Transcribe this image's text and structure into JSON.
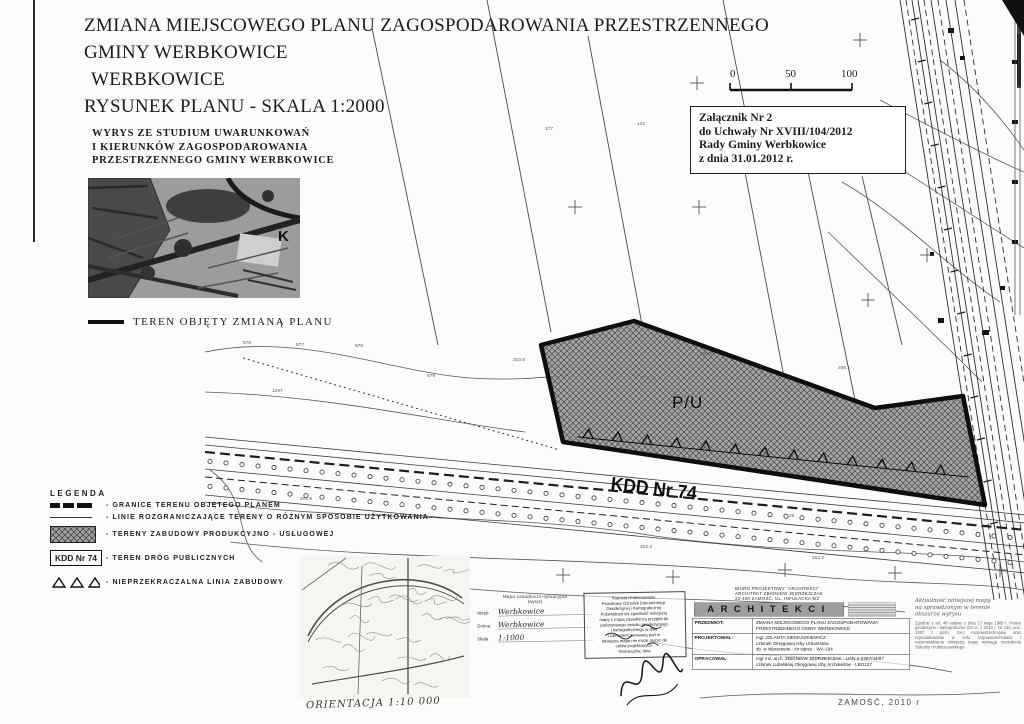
{
  "doc": {
    "title_lines": [
      "ZMIANA MIEJSCOWEGO PLANU ZAGOSPODAROWANIA PRZESTRZENNEGO",
      "GMINY WERBKOWICE",
      "WERBKOWICE",
      "RYSUNEK PLANU - SKALA 1:2000"
    ],
    "wyrys_lines": [
      "WYRYS ZE STUDIUM UWARUNKOWAŃ",
      "I KIERUNKÓW ZAGOSPODAROWANIA",
      "PRZESTRZENNEGO GMINY WERBKOWICE"
    ],
    "study_map_letter": "K",
    "teren_objety": "TEREN OBJĘTY ZMIANĄ PLANU",
    "scale_bar": {
      "labels": [
        "0",
        "50",
        "100"
      ]
    },
    "zalacznik_lines": [
      "Załącznik Nr 2",
      "do Uchwały Nr XVIII/104/2012",
      "Rady Gminy Werbkowice",
      "z dnia 31.01.2012 r."
    ],
    "legend": {
      "heading": "LEGENDA",
      "items": [
        "- GRANICE TERENU OBJĘTEGO PLANEM",
        "- LINIE ROZGRANICZAJĄCE TERENY O RÓŻNYM SPOSOBIE UŻYTKOWANIA",
        "- TERENY ZABUDOWY PRODUKCYJNO - USŁUGOWEJ",
        "- TEREN DRÓG PUBLICZNYCH",
        "- NIEPRZEKRACZALNA LINIA ZABUDOWY"
      ],
      "kdd_symbol": "KDD Nr 74"
    },
    "map": {
      "pu_label": "P/U",
      "kdd_label": "KDD Nr 74",
      "parcel_labels": [
        {
          "text": "177",
          "x": 545,
          "y": 127
        },
        {
          "text": "122",
          "x": 637,
          "y": 122
        },
        {
          "text": "578",
          "x": 243,
          "y": 341
        },
        {
          "text": "577",
          "x": 296,
          "y": 343
        },
        {
          "text": "578",
          "x": 355,
          "y": 344
        },
        {
          "text": "579",
          "x": 427,
          "y": 374
        },
        {
          "text": "1297",
          "x": 272,
          "y": 389
        },
        {
          "text": "203.6",
          "x": 513,
          "y": 358
        },
        {
          "text": "205.8",
          "x": 700,
          "y": 352
        },
        {
          "text": "206.1",
          "x": 838,
          "y": 366
        },
        {
          "text": "202.3",
          "x": 640,
          "y": 545
        },
        {
          "text": "204.2",
          "x": 812,
          "y": 556
        },
        {
          "text": "201.8",
          "x": 300,
          "y": 497
        },
        {
          "text": "26",
          "x": 789,
          "y": 514
        }
      ]
    },
    "orientation_caption": "ORIENTACJA 1:10 000",
    "survey_form": {
      "title": "Mapa zasadniczo-sytuacyjna",
      "subtitle": "(wyrys)",
      "rows": [
        {
          "label": "obręb",
          "value": "Werbkowice"
        },
        {
          "label": "Gmina",
          "value": "Werbkowice"
        },
        {
          "label": "Skala",
          "value": "1:1000"
        }
      ]
    },
    "stamp_lines": [
      "Starosta Hrubieszowski",
      "Powiatowy Ośrodek Dokumentacji",
      "Geodezyjnej i Kartograficznej",
      "Poświadcza się zgodność niniejszej",
      "mapy z mapą zasadniczą przyjętą do",
      "państwowego zasobu geodezyjnego",
      "i kartograficznego w dniu",
      "i zaewidencjonowaną pod nr",
      "Niniejsza mapa nie może służyć do",
      "celów projektowych.",
      "Hrubieszów, dnia"
    ],
    "architekci": {
      "header_lines": [
        "BIURO PROJEKTOWY \"ARCHITEKCI\"",
        "ARCHITEKT ZBIGNIEW JĘDRZEJCZAK",
        "22-400 ZAMOŚĆ, UL. INFUŁACKA 9/2"
      ],
      "banner": "ARCHITEKCI",
      "rows": [
        {
          "label": "PRZEDMIOT:",
          "lines": [
            "ZMIANA MIEJSCOWEGO PLANU ZAGOSPODAROWANIA",
            "PRZESTRZENNEGO GMINY WERBKOWICE"
          ]
        },
        {
          "label": "PROJEKTOWAŁ:",
          "lines": [
            "mgr JOLANTA SIEMASZKIEWICZ",
            "członek Okręgowej Izby Urbanistów",
            "zb. w Warszawie - Nr wpisu - WA-194"
          ]
        },
        {
          "label": "OPRACOWAŁ:",
          "lines": [
            "mgr inż. arch. ZBIGNIEW JĘDRZEJCZAK - UAN-II-8387/44/87",
            "członek Lubelskiej Okręgowej Izby Architektów - LBO137"
          ]
        }
      ]
    },
    "certification": {
      "heading_lines": [
        "Aktualność niniejszej mapy",
        "na sprawdzonym w terenie",
        "obszarze wyrysu"
      ],
      "body": "Zgodnie z art. 48 ustawy z dnia 17 maja 1989 r. Prawo geodezyjne i kartograficzne (Dz.U. z 2010 r. Nr 193, poz. 1287 z późn. zm.) rozpowszechnianie oraz reprodukowanie w celu rozpowszechniania i rozprowadzania niniejszej mapy wymaga zezwolenia Starosty Hrubieszowskiego"
    },
    "footer": "ZAMOŚĆ, 2010 r"
  },
  "colors": {
    "ink": "#1c1c1c",
    "pu_hatch_fill": "#a0a0a0",
    "banner_bg": "#9e9e9e",
    "paper": "#fcfcfa"
  }
}
